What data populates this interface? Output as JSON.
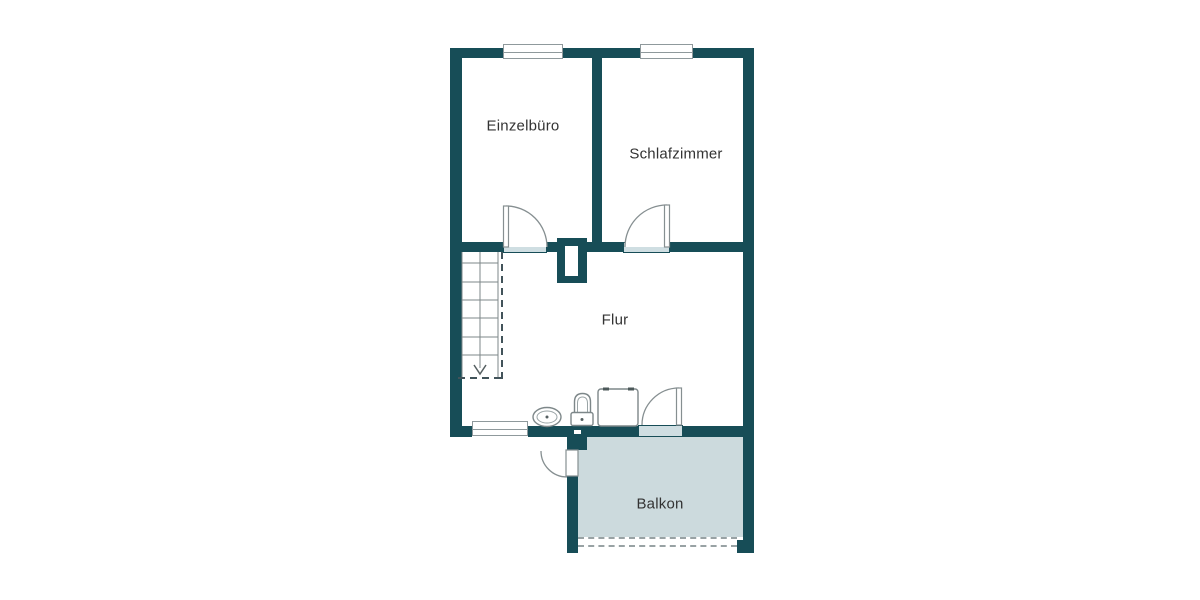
{
  "title": "Floor plan",
  "colors": {
    "wall": "#174d57",
    "threshold": "#cfdee2",
    "balcony": "#ccdadd",
    "window_border": "#8f999c",
    "fixture": "#7d8789",
    "dash": "#42535a",
    "label_text": "#333333",
    "bg": "#ffffff"
  },
  "rooms": [
    {
      "name": "einzelbuero",
      "label": "Einzelbüro"
    },
    {
      "name": "schlafzimmer",
      "label": "Schlafzimmer"
    },
    {
      "name": "flur",
      "label": "Flur"
    },
    {
      "name": "balkon",
      "label": "Balkon"
    }
  ],
  "fixtures": [
    {
      "icon": "sink-icon"
    },
    {
      "icon": "toilet-icon"
    },
    {
      "icon": "washing-machine-icon"
    },
    {
      "icon": "staircase-down-icon"
    },
    {
      "icon": "chimney-shaft-icon"
    }
  ],
  "features": {
    "windows": 3,
    "doors": 4,
    "stair_direction": "down",
    "balcony_railing": "dashed-open-side"
  }
}
